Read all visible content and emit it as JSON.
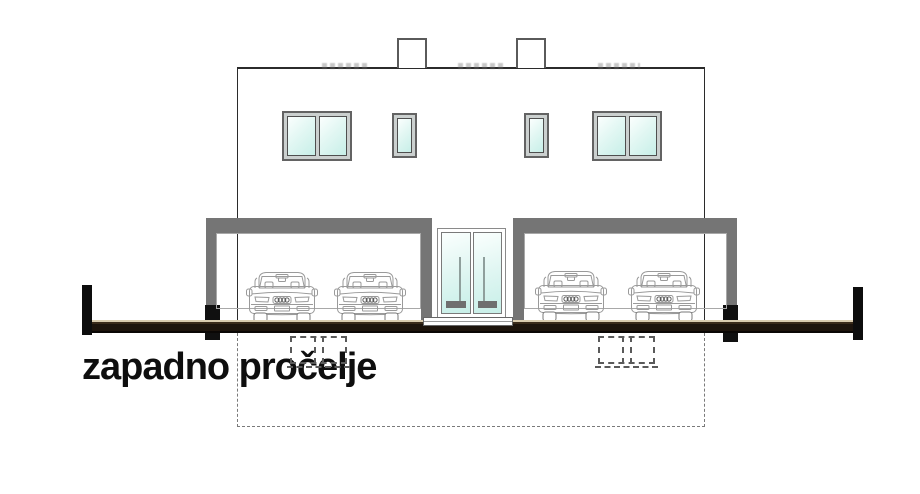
{
  "title": {
    "label": "zapadno pročelje"
  },
  "drawing": {
    "kind": "architectural west-facade elevation",
    "counts": {
      "chimneys": 2,
      "large_windows": 2,
      "small_windows": 2,
      "door_leaves": 2,
      "carport_bays": 2,
      "cars": 4,
      "foundation_footings": 2
    }
  },
  "colors": {
    "canopy": "#757575",
    "ink": "#2b2b2b",
    "black": "#0d0d0d",
    "glassLight": "#fbfffe",
    "glassCyan": "#c7efe8",
    "frameFill": "#cbd0cf",
    "groundTan": "#d9cbae",
    "groundDark": "#1d140c",
    "dash": "#7a7a7a",
    "carLine": "#9a9a9a"
  }
}
